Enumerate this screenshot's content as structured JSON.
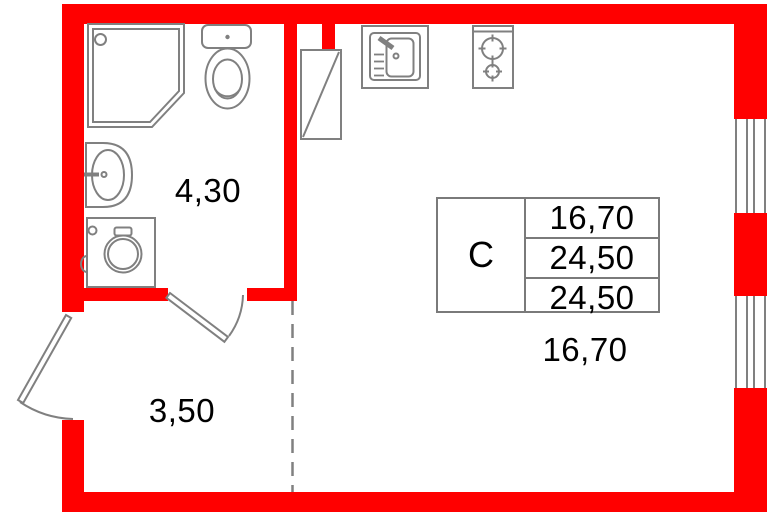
{
  "floor_plan": {
    "areas": {
      "bathroom": "4,30",
      "hallway": "3,50",
      "main_room": "16,70"
    },
    "unit_table": {
      "unit_type": "С",
      "values": [
        "16,70",
        "24,50",
        "24,50"
      ]
    },
    "colors": {
      "wall": "#ff0000",
      "fixture_outline": "#808080",
      "table_border": "#7a7a7a",
      "text": "#000000"
    },
    "fixtures": [
      "shower-cabin",
      "toilet",
      "washbasin",
      "washing-machine",
      "wardrobe",
      "kitchen-sink",
      "stove",
      "window",
      "window",
      "entry-door",
      "bathroom-door"
    ]
  }
}
